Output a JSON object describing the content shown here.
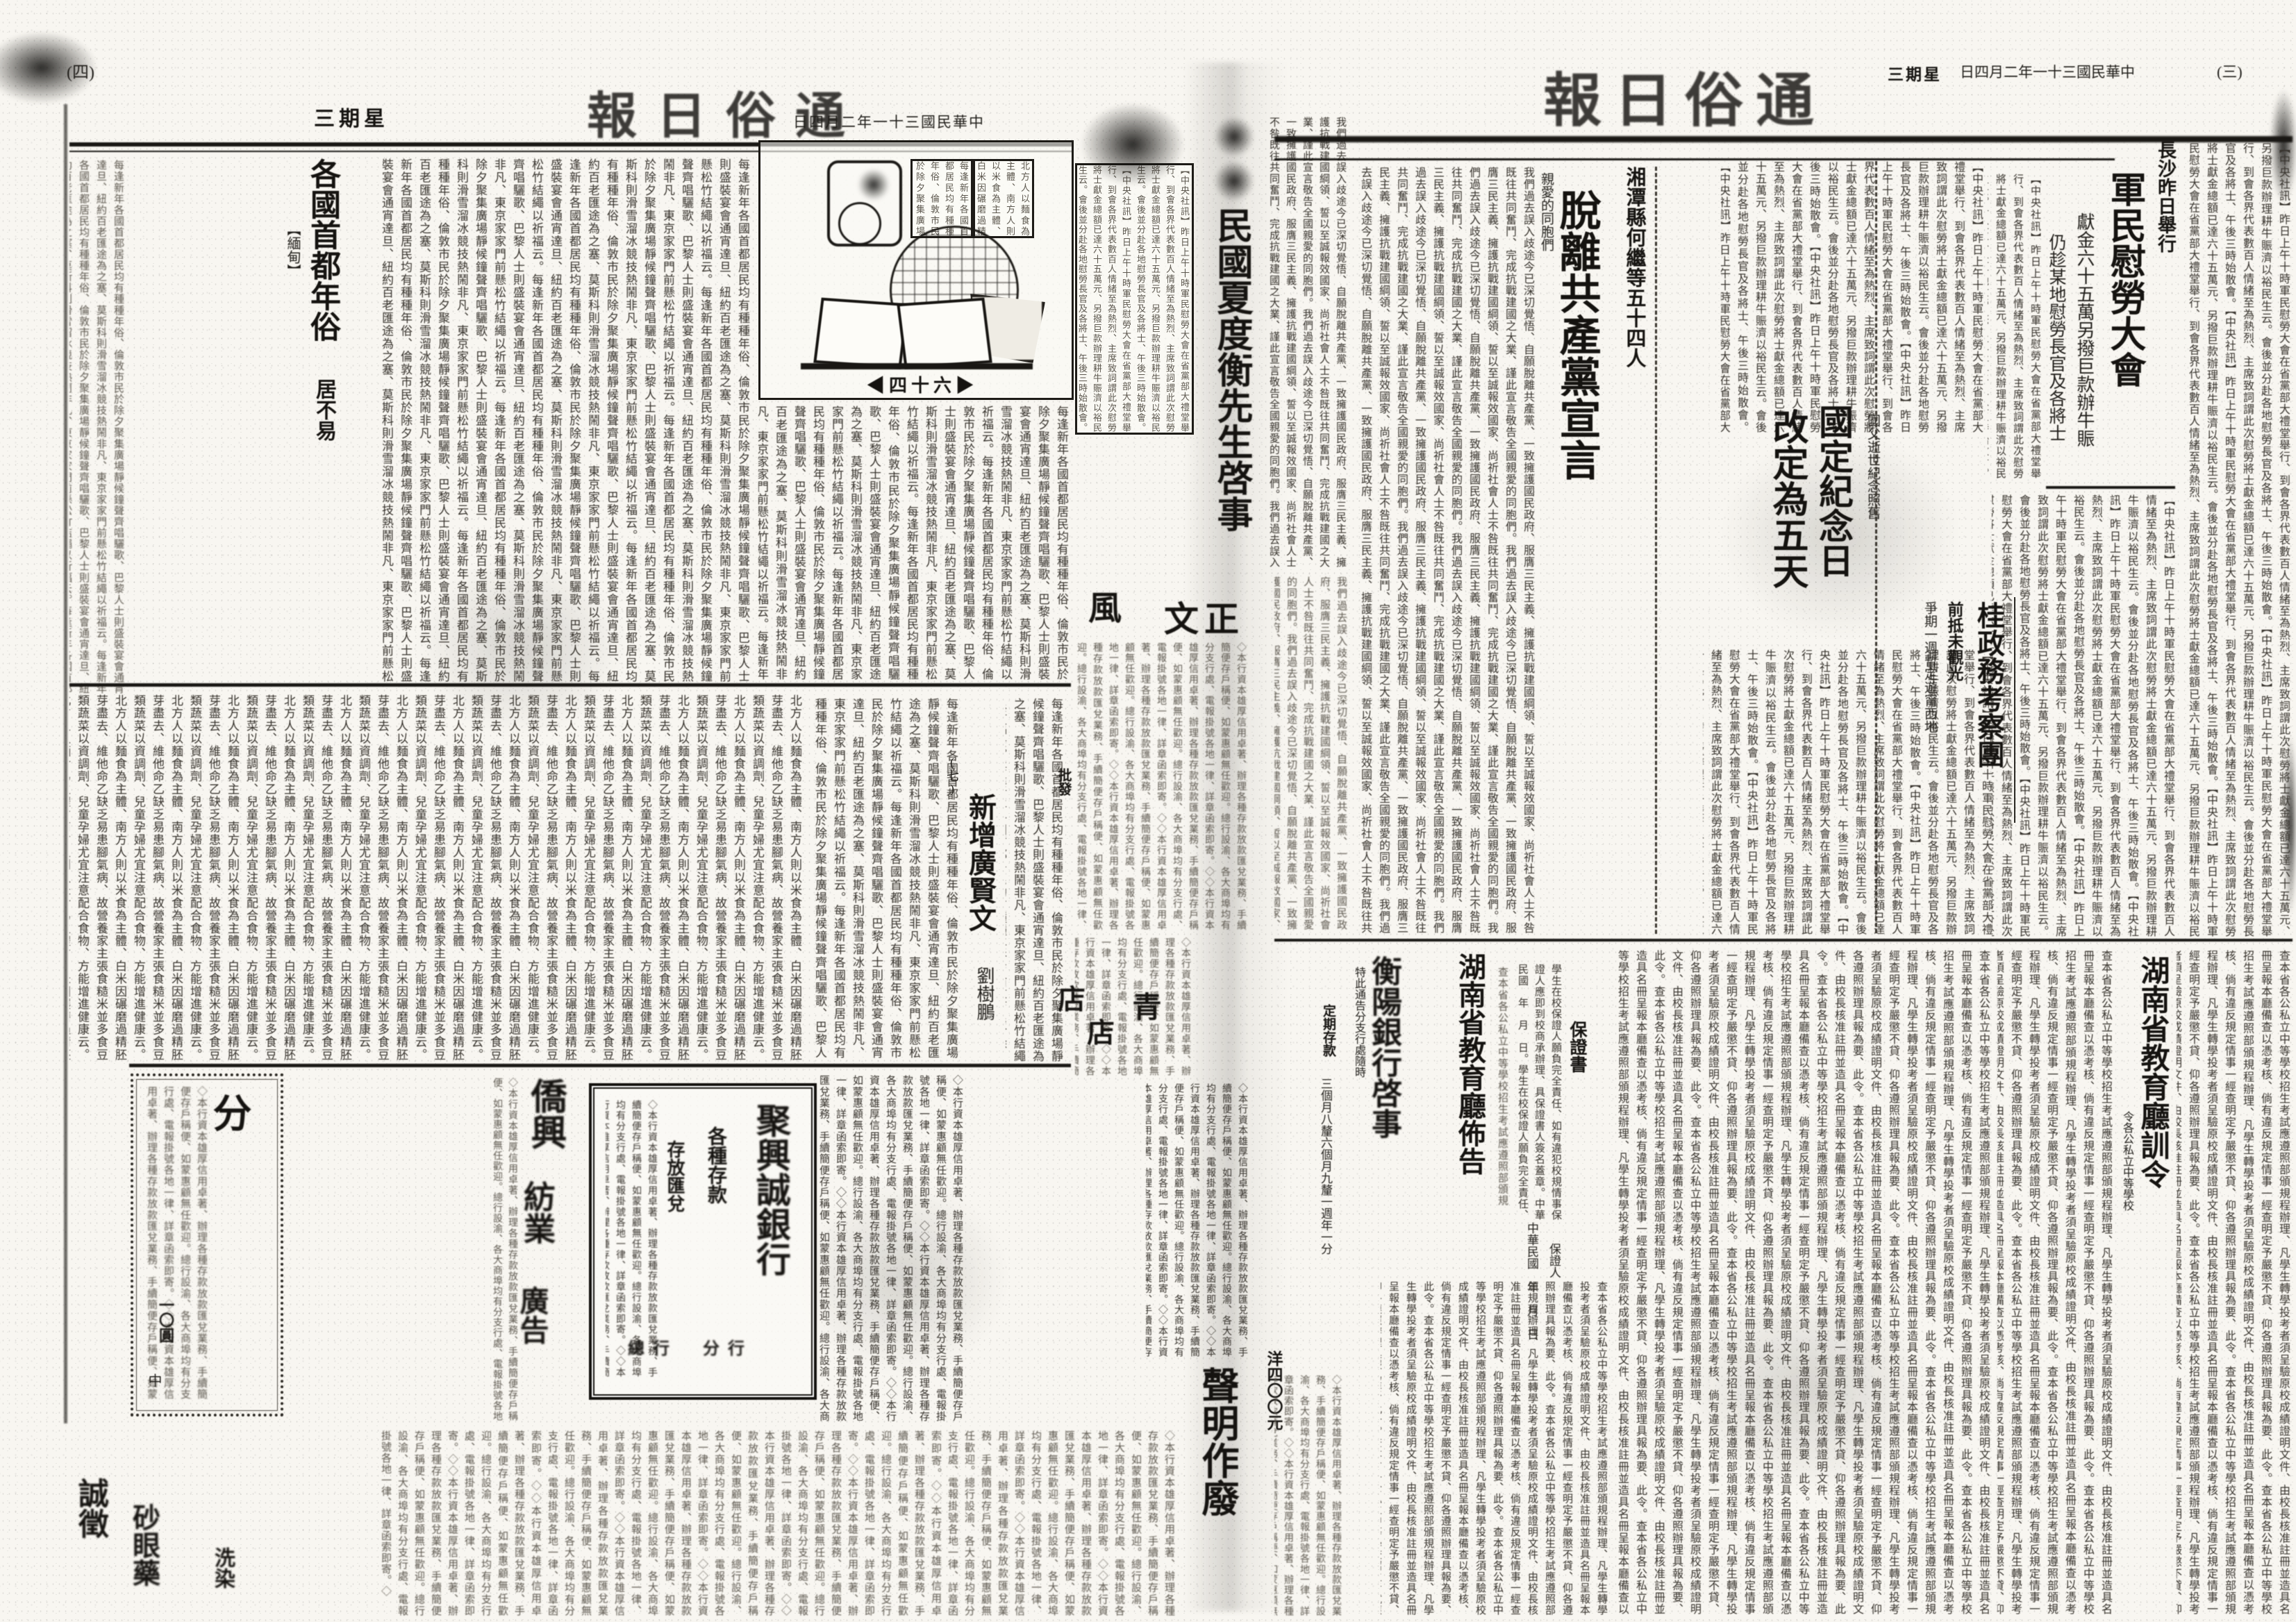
{
  "meta": {
    "paper": "通俗日報",
    "masthead_display": "報日俗通",
    "date": "中華民國三十一年二月四日",
    "date_display": "日四月二年一十三國民華中",
    "weekday": "星期三",
    "weekday_display": "三期星",
    "page_left": "(四)",
    "page_right": "(三)"
  },
  "right_page": {
    "lead": {
      "kicker": "長沙昨日舉行",
      "title": "軍民慰勞大會",
      "sub1": "獻金六十五萬另撥巨款辦牛賑",
      "sub2": "仍趁某地慰勞長官及各將士"
    },
    "memorial": {
      "title_1": "國定紀念日",
      "title_2": "改定為五天",
      "kicker": "國父逝世紀念照舊"
    },
    "guangxi": {
      "title": "桂政務考察團",
      "sub1": "前抵未觀光",
      "sub2": "爭期一週暫定遊甯西地"
    },
    "declaration": {
      "kicker": "湘潭縣何繼等五十四人",
      "title": "脫離共產黨宣言",
      "lead": "親愛的同胞們"
    },
    "edu_order": {
      "title": "湖南省教育廳訓令",
      "kicker": "令各公私立中等學校"
    },
    "edu_notice": {
      "title": "湖南省教育廳佈告"
    },
    "guarantee": {
      "title": "保證書",
      "line": "中華民國　年　月　日",
      "signer": "保證人"
    },
    "bank_notice": {
      "title": "衡陽銀行啓事",
      "notice": "特此通告分支行處隨時",
      "deposit": "定期存款",
      "rates": "三個月八釐六個月九釐一週年一分"
    }
  },
  "left_page": {
    "customs": {
      "title": "各國首都年俗",
      "tag": "【緬甸】",
      "sub": "居不易"
    },
    "supplement": {
      "issue": "◀四十六▶"
    },
    "xianwen": {
      "title": "新增廣賢文",
      "author": "劉樹鵬",
      "marker": "(七)"
    },
    "ads": {
      "classified_char": "分",
      "classified_price": "一〇圓",
      "classified_mark": "中",
      "trade_big1": "僑興",
      "trade_big2": "紡業",
      "trade_big3": "廣告",
      "bank_name": "聚興誠銀行",
      "bank_line1": "各種存款",
      "bank_line2": "存放匯兌",
      "bank_foot": "總行　分行",
      "small_ad1": "誠徵",
      "small_ad2": "砂眼藥",
      "small_ad3": "洗染"
    }
  },
  "fold": {
    "notice_title": "民國夏度衡先生啓事",
    "char_wind": "風",
    "char_zhengwen": "文正",
    "char_shop1": "店",
    "char_shop2": "店",
    "char_qing": "青",
    "char_pifa": "批發",
    "void_notice": "聲明作廢",
    "price": "洋四〇〇元"
  },
  "fillers": {
    "news1": "【中央社訊】昨日上午十時軍民慰勞大會在省黨部大禮堂舉行、到會各界代表數百人情緒至為熱烈、主席致詞謂此次慰勞將士獻金總額已達六十五萬元、另撥巨款辦理耕牛賑濟以裕民生云。會後並分赴各地慰勞長官及各將士、午後三時始散會。",
    "news2": "查本省各公私立中等學校招生考試應遵照部頒規程辦理、凡學生轉學投考者須呈驗原校成績證明文件、由校長核准註冊並造具名冊呈報本廳備查以憑考核、倘有違反規定情事一經查明定予嚴懲不貸、仰各遵照辦理具報為要、此令。",
    "news3": "我們過去誤入歧途今已深切覺悟、自願脫離共產黨、一致擁護國民政府、服膺三民主義、擁護抗戰建國綱領、誓以至誠報效國家、尚祈社會人士不咎既往共同奮鬥、完成抗戰建國之大業、謹此宣言敬告全國親愛的同胞們。",
    "news4": "每逢新年各國首都居民均有種種年俗、倫敦市民於除夕聚集廣場靜候鐘聲齊唱驪歌、巴黎人士則盛裝宴會通宵達旦、紐約百老匯途為之塞、莫斯科則滑雪溜冰競技熱鬧非凡、東京家家門前懸松竹結繩以祈福云。",
    "news5": "北方人以麵食為主體、南方人則以米食為主體、白米因碾磨過精胚芽盡去、維他命乙缺乏易患腳氣病、故營養家主張食糙米並多食豆類蔬菜以資調劑、兒童孕婦尤宜注意配合食物、方能增進健康云。",
    "adtext": "◇本行資本雄厚信用卓著、辦理各種存款放款匯兌業務、手續簡便存戶稱便、如蒙惠顧無任歡迎。總行設渝、各大商埠均有分支行處、電報掛號各地一律、詳章函索即寄。◇",
    "formtext": "學生在校保證人願負完全責任、如有違犯校規情事保證人應即到校商承辦理、具保證書人簽名蓋章。中華民國　年　月　日。"
  }
}
